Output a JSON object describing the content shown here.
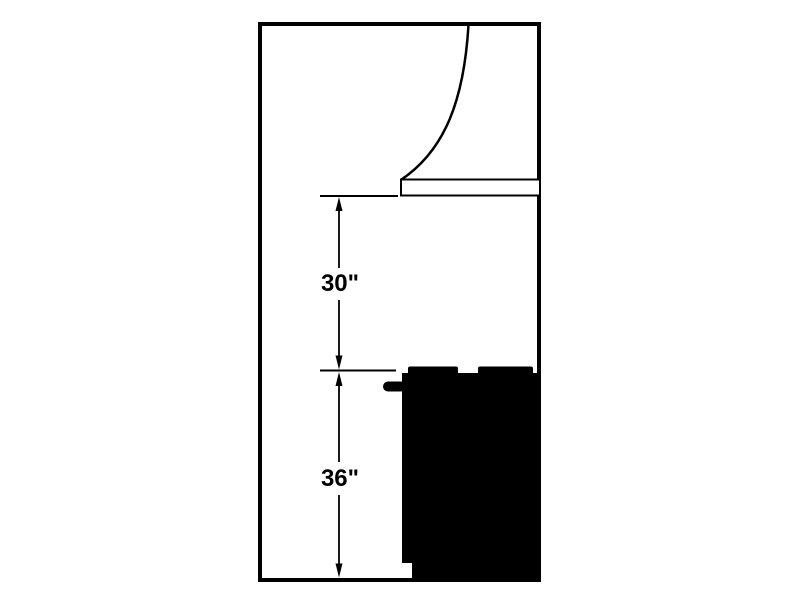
{
  "diagram": {
    "type": "range-hood-installation-clearance-side-elevation",
    "background_color": "#ffffff",
    "line_color": "#000000",
    "fill_color": "#000000",
    "labels": {
      "hood_to_cooktop": "30\"",
      "floor_to_cooktop": "36\""
    }
  }
}
